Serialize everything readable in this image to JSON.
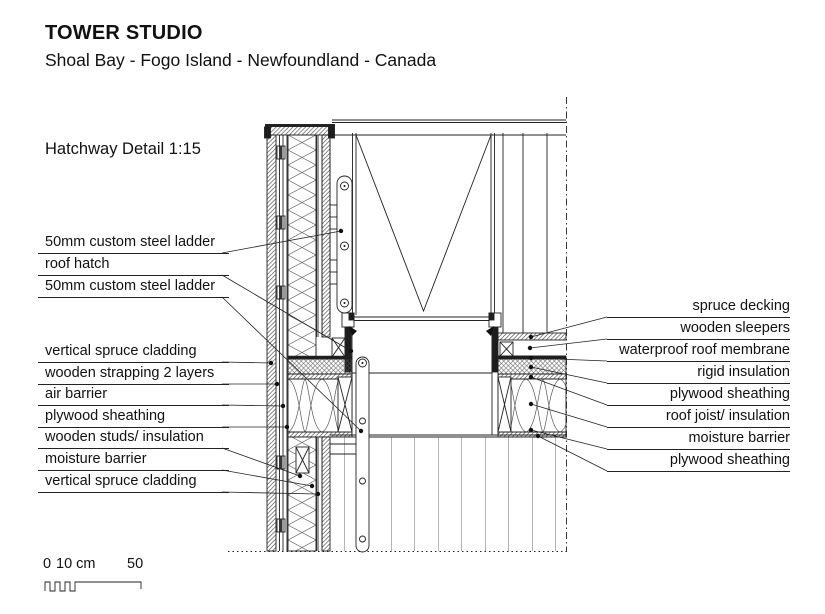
{
  "header": {
    "title": "TOWER STUDIO",
    "location": "Shoal Bay - Fogo Island - Newfoundland - Canada"
  },
  "detail": {
    "title": "Hatchway Detail 1:15"
  },
  "labels_left": [
    "50mm custom steel ladder",
    "roof hatch",
    "50mm custom steel ladder",
    "vertical spruce cladding",
    "wooden strapping 2 layers",
    "air barrier",
    "plywood sheathing",
    "wooden studs/ insulation",
    "moisture barrier",
    "vertical spruce cladding"
  ],
  "labels_right": [
    "spruce decking",
    "wooden sleepers",
    "waterproof roof membrane",
    "rigid insulation",
    "plywood sheathing",
    "roof joist/ insulation",
    "moisture barrier",
    "plywood sheathing"
  ],
  "scale_bar": {
    "start": "0",
    "mid": "10 cm",
    "end": "50"
  },
  "colors": {
    "line": "#222222",
    "dark_fill": "#1d1d1d",
    "background": "#ffffff"
  }
}
